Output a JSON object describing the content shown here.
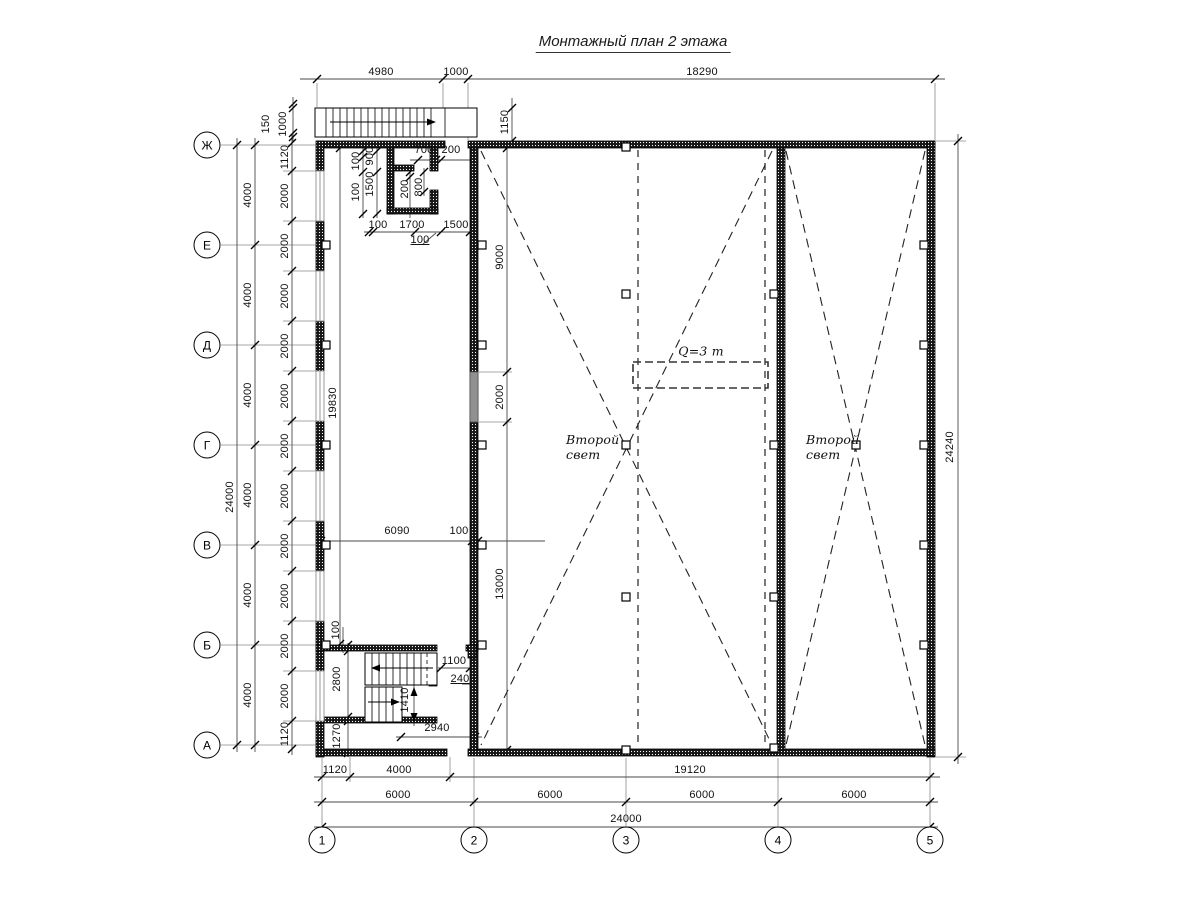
{
  "title": "Монтажный план 2 этажа",
  "row_axes": [
    {
      "label": "Ж",
      "y": 145
    },
    {
      "label": "Е",
      "y": 245
    },
    {
      "label": "Д",
      "y": 345
    },
    {
      "label": "Г",
      "y": 445
    },
    {
      "label": "В",
      "y": 545
    },
    {
      "label": "Б",
      "y": 645
    },
    {
      "label": "А",
      "y": 745
    }
  ],
  "col_axes": [
    {
      "label": "1",
      "x": 322
    },
    {
      "label": "2",
      "x": 474
    },
    {
      "label": "3",
      "x": 626
    },
    {
      "label": "4",
      "x": 778
    },
    {
      "label": "5",
      "x": 930
    }
  ],
  "annotations": {
    "crane_capacity": "Q=3 т",
    "double_height_left": "Второй\nсвет",
    "double_height_right": "Второй\nсвет"
  },
  "labels": [
    {
      "t": "4980",
      "x": 381,
      "y": 72
    },
    {
      "t": "1000",
      "x": 456,
      "y": 72
    },
    {
      "t": "18290",
      "x": 702,
      "y": 72
    },
    {
      "t": "150",
      "x": 266,
      "y": 124,
      "r": 1
    },
    {
      "t": "1000",
      "x": 283,
      "y": 124,
      "r": 1
    },
    {
      "t": "1150",
      "x": 505,
      "y": 122,
      "r": 1
    },
    {
      "t": "100",
      "x": 356,
      "y": 161,
      "r": 1
    },
    {
      "t": "900",
      "x": 370,
      "y": 156,
      "r": 1
    },
    {
      "t": "700",
      "x": 424,
      "y": 150
    },
    {
      "t": "200",
      "x": 451,
      "y": 150
    },
    {
      "t": "100",
      "x": 356,
      "y": 192,
      "r": 1
    },
    {
      "t": "1500",
      "x": 370,
      "y": 184,
      "r": 1
    },
    {
      "t": "200",
      "x": 405,
      "y": 189,
      "r": 1
    },
    {
      "t": "800",
      "x": 419,
      "y": 187,
      "r": 1
    },
    {
      "t": "100",
      "x": 378,
      "y": 225
    },
    {
      "t": "1700",
      "x": 412,
      "y": 225
    },
    {
      "t": "1500",
      "x": 456,
      "y": 225
    },
    {
      "t": "100",
      "x": 420,
      "y": 240,
      "c": "u"
    },
    {
      "t": "1120",
      "x": 285,
      "y": 157,
      "r": 1
    },
    {
      "t": "2000",
      "x": 285,
      "y": 196,
      "r": 1
    },
    {
      "t": "2000",
      "x": 285,
      "y": 246,
      "r": 1
    },
    {
      "t": "2000",
      "x": 285,
      "y": 296,
      "r": 1
    },
    {
      "t": "2000",
      "x": 285,
      "y": 346,
      "r": 1
    },
    {
      "t": "2000",
      "x": 285,
      "y": 396,
      "r": 1
    },
    {
      "t": "2000",
      "x": 285,
      "y": 446,
      "r": 1
    },
    {
      "t": "2000",
      "x": 285,
      "y": 496,
      "r": 1
    },
    {
      "t": "2000",
      "x": 285,
      "y": 546,
      "r": 1
    },
    {
      "t": "2000",
      "x": 285,
      "y": 596,
      "r": 1
    },
    {
      "t": "2000",
      "x": 285,
      "y": 646,
      "r": 1
    },
    {
      "t": "2000",
      "x": 285,
      "y": 696,
      "r": 1
    },
    {
      "t": "1120",
      "x": 285,
      "y": 734,
      "r": 1
    },
    {
      "t": "4000",
      "x": 248,
      "y": 195,
      "r": 1
    },
    {
      "t": "4000",
      "x": 248,
      "y": 295,
      "r": 1
    },
    {
      "t": "4000",
      "x": 248,
      "y": 395,
      "r": 1
    },
    {
      "t": "4000",
      "x": 248,
      "y": 495,
      "r": 1
    },
    {
      "t": "4000",
      "x": 248,
      "y": 595,
      "r": 1
    },
    {
      "t": "4000",
      "x": 248,
      "y": 695,
      "r": 1
    },
    {
      "t": "24000",
      "x": 230,
      "y": 497,
      "r": 1
    },
    {
      "t": "19830",
      "x": 333,
      "y": 403,
      "r": 1
    },
    {
      "t": "6090",
      "x": 397,
      "y": 531
    },
    {
      "t": "100",
      "x": 459,
      "y": 531
    },
    {
      "t": "9000",
      "x": 500,
      "y": 257,
      "r": 1
    },
    {
      "t": "2000",
      "x": 500,
      "y": 397,
      "r": 1
    },
    {
      "t": "13000",
      "x": 500,
      "y": 584,
      "r": 1
    },
    {
      "t": "100",
      "x": 336,
      "y": 630,
      "r": 1
    },
    {
      "t": "2800",
      "x": 337,
      "y": 679,
      "r": 1
    },
    {
      "t": "1270",
      "x": 337,
      "y": 736,
      "r": 1
    },
    {
      "t": "1410",
      "x": 405,
      "y": 700,
      "r": 1
    },
    {
      "t": "1100",
      "x": 454,
      "y": 661
    },
    {
      "t": "240",
      "x": 460,
      "y": 679,
      "c": "u"
    },
    {
      "t": "2940",
      "x": 437,
      "y": 728
    },
    {
      "t": "24240",
      "x": 950,
      "y": 447,
      "r": 1
    },
    {
      "t": "1120",
      "x": 335,
      "y": 770
    },
    {
      "t": "4000",
      "x": 399,
      "y": 770
    },
    {
      "t": "19120",
      "x": 690,
      "y": 770
    },
    {
      "t": "6000",
      "x": 398,
      "y": 795
    },
    {
      "t": "6000",
      "x": 550,
      "y": 795
    },
    {
      "t": "6000",
      "x": 702,
      "y": 795
    },
    {
      "t": "6000",
      "x": 854,
      "y": 795
    },
    {
      "t": "24000",
      "x": 626,
      "y": 819
    }
  ]
}
